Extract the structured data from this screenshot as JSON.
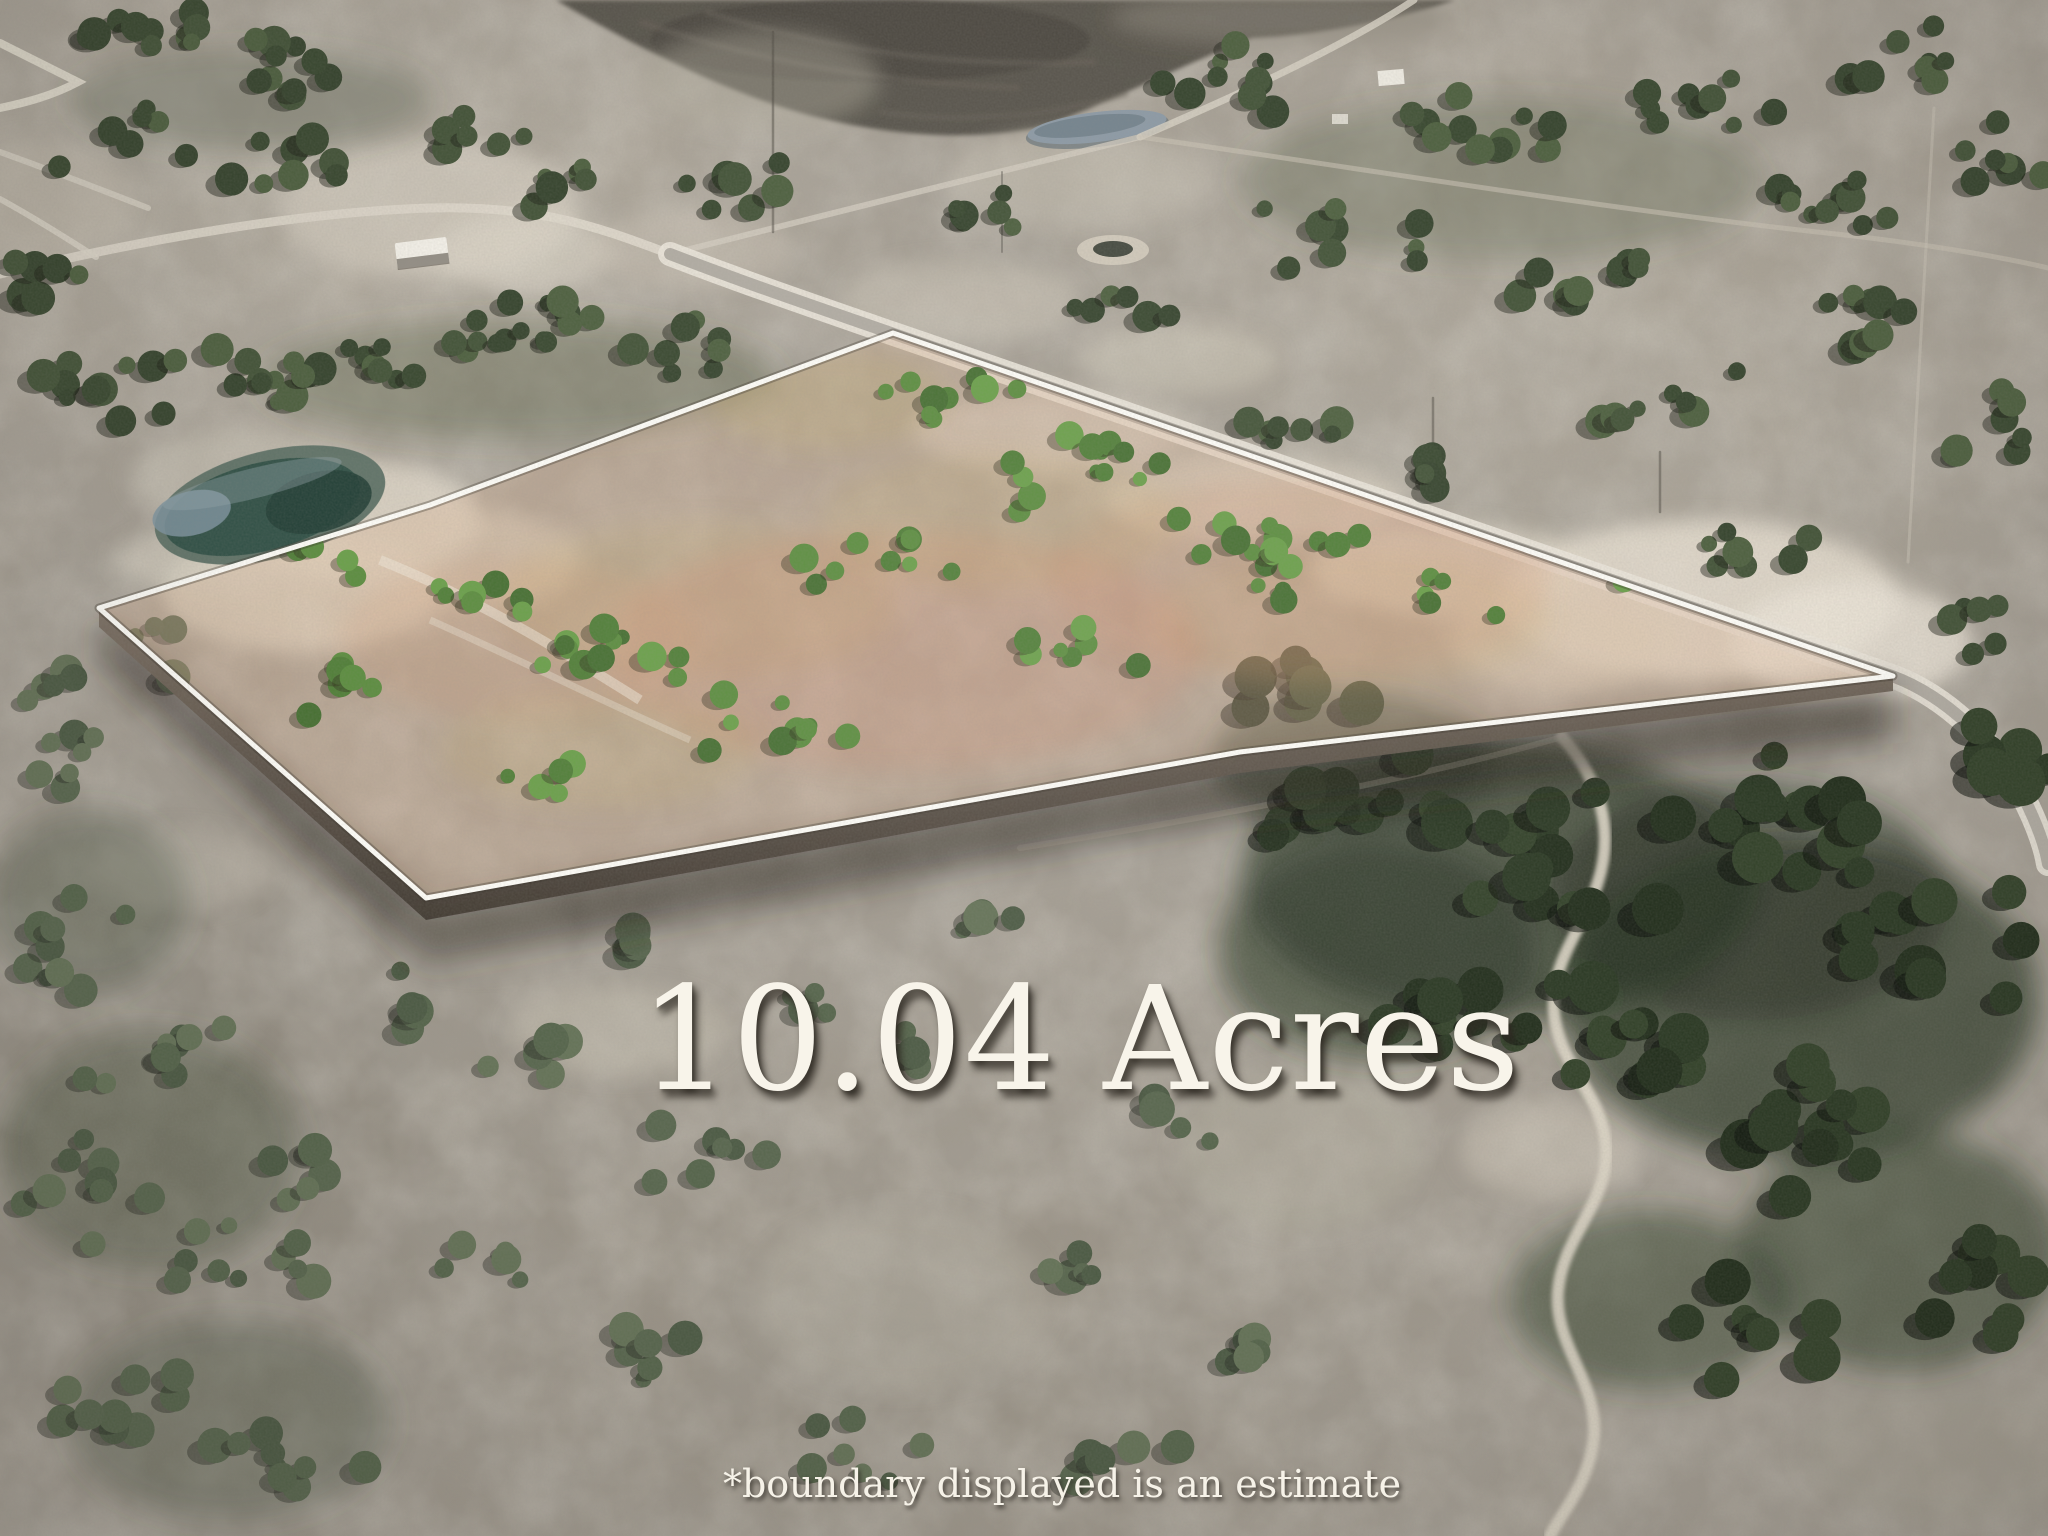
{
  "scene": {
    "type": "aerial-photograph",
    "subject": "rural land parcel with highlighted boundary"
  },
  "labels": {
    "acreage": "10.04 Acres",
    "disclaimer": "*boundary displayed is an estimate"
  },
  "parcel": {
    "acres": "10.04",
    "boundary_points": "99,608 430,505 893,333 1893,676 1240,752 426,898",
    "boundary_color": "#fdfcf7"
  },
  "colors": {
    "terrain_base": "#a49d92",
    "terrain_light": "#d8d1c3",
    "terrain_shadow": "#7f786e",
    "parcel_tint": "#d09a72",
    "tree_dark": "#2d3b26",
    "tree_olive": "#46563b",
    "tree_bright": "#5e8e42",
    "road_surface": "#b2ada4",
    "road_edge": "#e9e4d9",
    "pond_teal": "#35544a",
    "pond_gray_blue": "#8e9ba6",
    "plowed_field": "#57534b",
    "label_text": "#f8f4ea",
    "label_shadow": "rgba(50,45,38,0.8)"
  }
}
